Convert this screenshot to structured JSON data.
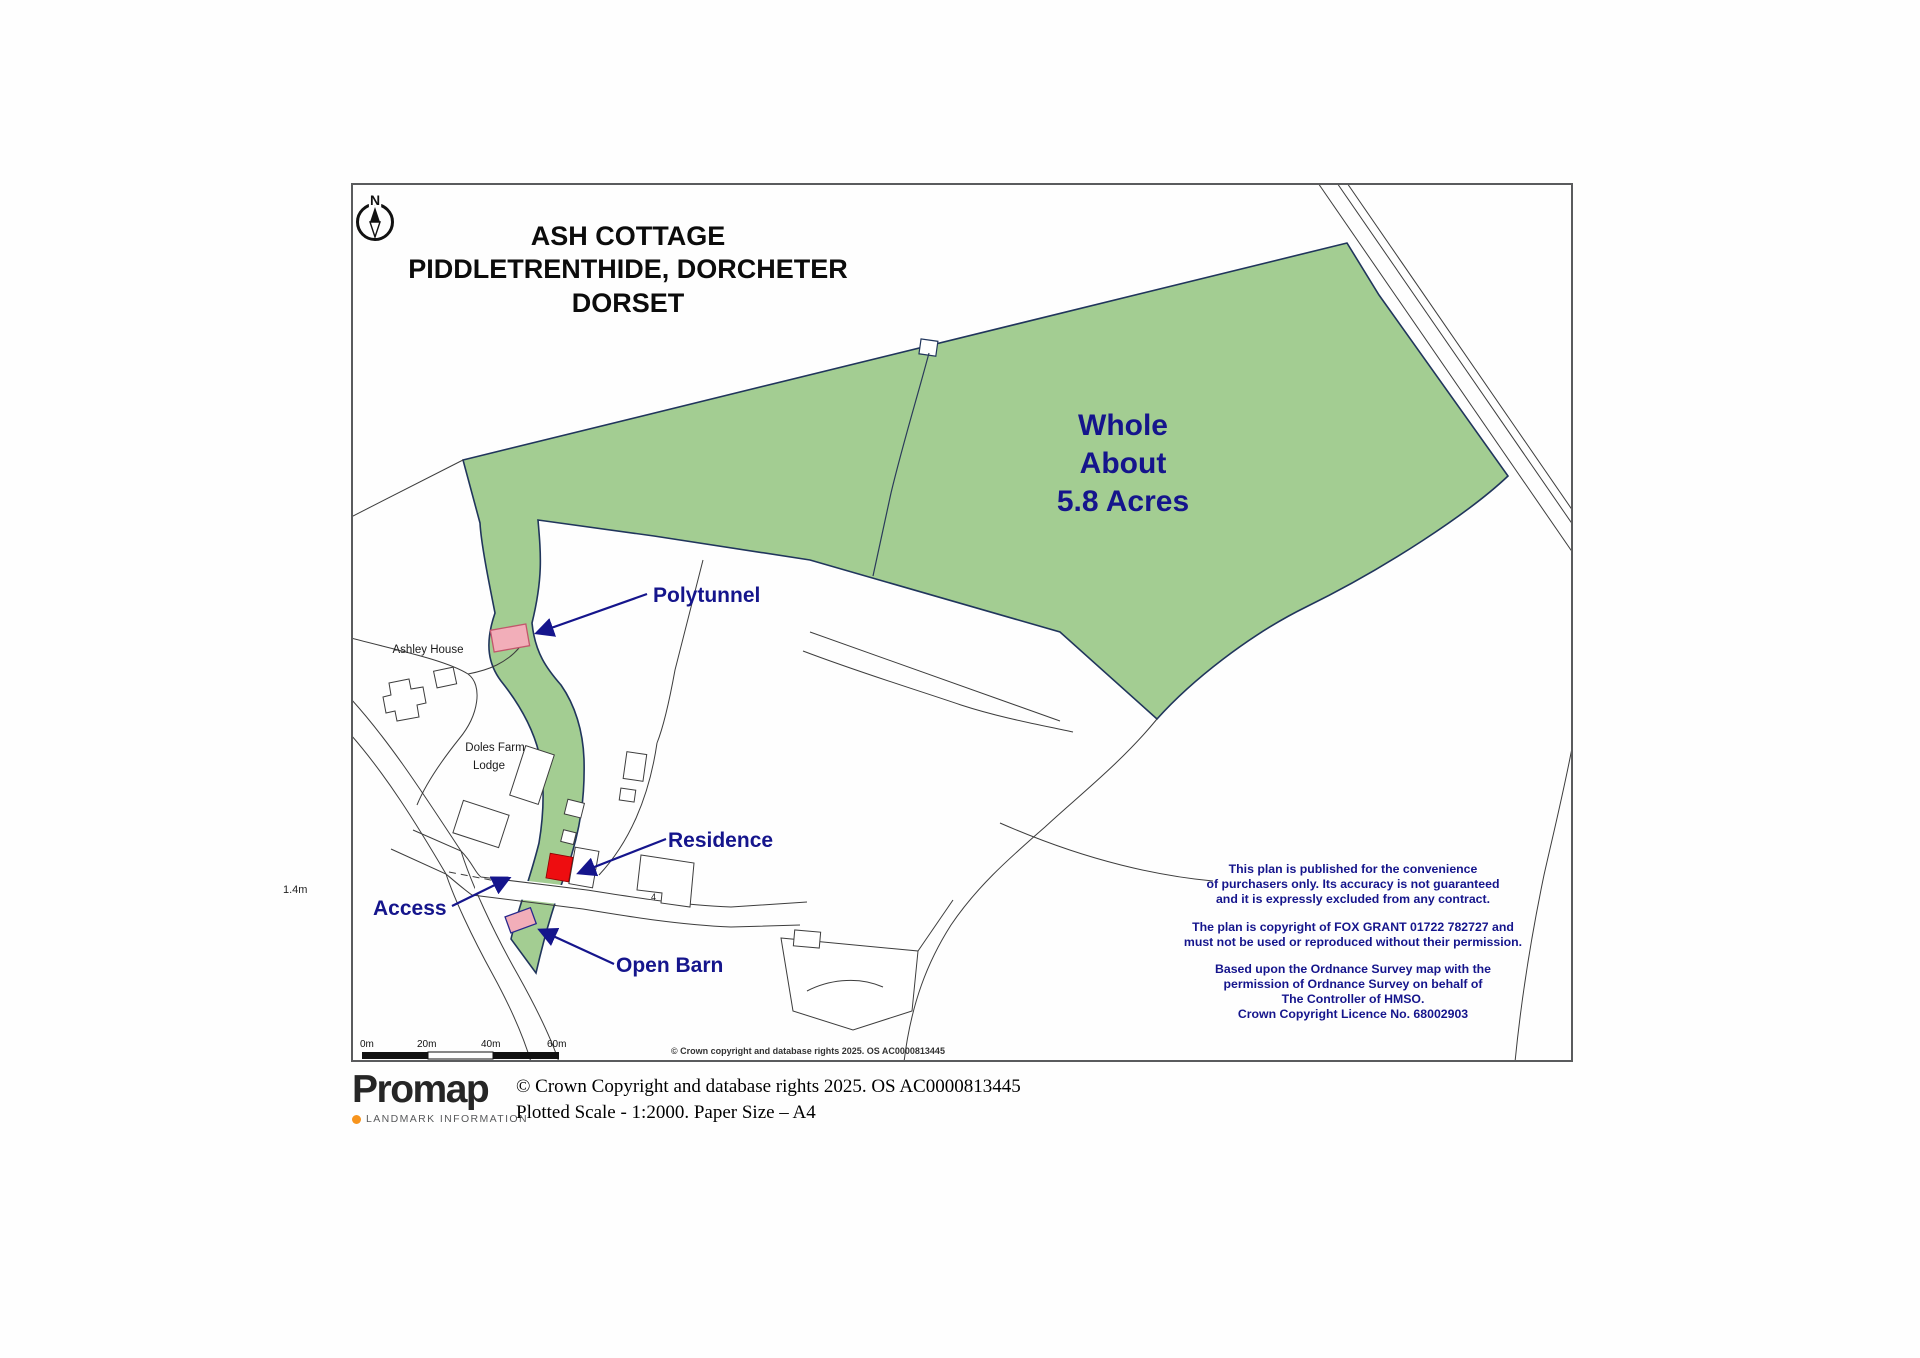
{
  "map": {
    "title": [
      "ASH COTTAGE",
      "PIDDLETRENTHIDE, DORCHETER",
      "DORSET"
    ],
    "north_label": "N",
    "acreage": [
      "Whole",
      "About",
      "5.8 Acres"
    ],
    "features": {
      "polytunnel": "Polytunnel",
      "residence": "Residence",
      "access": "Access",
      "open_barn": "Open Barn"
    },
    "places": {
      "ashley_house": "Ashley House",
      "doles_farm_line1": "Doles Farm",
      "doles_farm_line2": "Lodge",
      "spot_height": "1.4m",
      "plot_number": "4"
    },
    "disclaimer": [
      "This plan is published for the convenience",
      "of purchasers only.  Its accuracy is not guaranteed",
      "and it is expressly excluded from any contract.",
      "The plan is copyright of FOX GRANT 01722 782727  and",
      "must not be used or reproduced without their permission.",
      "Based upon the Ordnance Survey map with the",
      "permission of Ordnance Survey on behalf of",
      "The Controller of HMSO.",
      "Crown Copyright Licence No. 68002903"
    ],
    "scale_bar": [
      "0m",
      "20m",
      "40m",
      "60m"
    ],
    "map_copyright": "© Crown copyright and database rights 2025. OS AC0000813445",
    "colors": {
      "parcel_green": "#a3cd92",
      "parcel_edge": "#20355c",
      "label_navy": "#15158c",
      "residence_red": "#ee0d10",
      "marker_pink": "#f2aeb9"
    }
  },
  "footer": {
    "logo_text": "Promap",
    "logo_subtext": "LANDMARK INFORMATION",
    "copyright_line": "© Crown Copyright and database rights 2025. OS AC0000813445",
    "scale_line": "Plotted Scale - 1:2000. Paper Size – A4"
  }
}
